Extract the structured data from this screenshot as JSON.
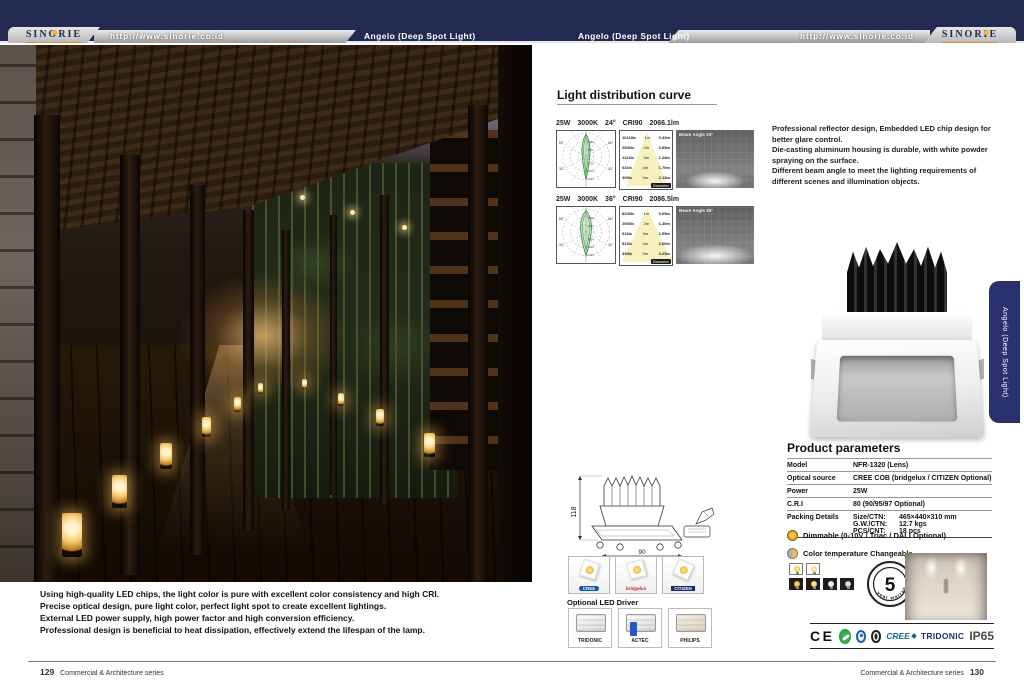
{
  "colors": {
    "header_navy": "#232a52",
    "tab_navy": "#2a3170",
    "accent_yellow": "#f0b41e",
    "cert_green": "#1d8a37"
  },
  "header": {
    "brand": "SINORIE",
    "url": "http://www.sinorie.co.id",
    "product": "Angelo (Deep Spot Light)"
  },
  "left_page": {
    "description": {
      "line1": "Using high-quality LED chips, the light color is pure with excellent color consistency and high CRI.",
      "line2": "Precise optical design, pure light color, perfect light spot to create excellent lightings.",
      "line3": "External LED power supply, high power factor and high conversion efficiency.",
      "line4": "Professional design is beneficial to heat dissipation, effectively extend the lifespan of the lamp."
    },
    "footer": {
      "page_number": "129",
      "series": "Commercial & Architecture series"
    }
  },
  "right_page": {
    "intro": {
      "line1": "Professional reflector design, Embedded LED chip design for better glare control.",
      "line2": "Die-casting aluminum housing is durable, with white powder spraying on the surface.",
      "line3": "Different beam angle to meet the lighting requirements of different scenes and illumination objects."
    },
    "curve_section": {
      "title": "Light distribution curve",
      "angle_upper": "30°",
      "angle_lower": "60°",
      "rows": [
        {
          "spec": {
            "power": "25W",
            "cct": "3000K",
            "angle": "24°",
            "cri": "CRI90",
            "flux": "2066.1lm"
          },
          "beam_label": "Beam Angle  24°",
          "polar_scale": {
            "s1": "1426",
            "s2": "2852",
            "s3": "4278",
            "s4": "5704",
            "s5": "7130"
          },
          "cone": [
            {
              "lux": "10118lx",
              "dist": "1m",
              "dia": "0.43m"
            },
            {
              "lux": "2530lx",
              "dist": "2m",
              "dia": "0.85m"
            },
            {
              "lux": "1124lx",
              "dist": "3m",
              "dia": "1.28m"
            },
            {
              "lux": "632lx",
              "dist": "4m",
              "dia": "1.70m"
            },
            {
              "lux": "405lx",
              "dist": "5m",
              "dia": "2.13m"
            }
          ],
          "cone_footer": "Diameter"
        },
        {
          "spec": {
            "power": "25W",
            "cct": "3000K",
            "angle": "36°",
            "cri": "CRI90",
            "flux": "2086.5lm"
          },
          "beam_label": "Beam Angle  36°",
          "polar_scale": {
            "s1": "1298",
            "s2": "2596",
            "s3": "3894",
            "s4": "5192",
            "s5": "6490"
          },
          "cone": [
            {
              "lux": "8240lx",
              "dist": "1m",
              "dia": "0.65m"
            },
            {
              "lux": "2060lx",
              "dist": "2m",
              "dia": "1.30m"
            },
            {
              "lux": "916lx",
              "dist": "3m",
              "dia": "1.95m"
            },
            {
              "lux": "515lx",
              "dist": "4m",
              "dia": "2.60m"
            },
            {
              "lux": "330lx",
              "dist": "5m",
              "dia": "3.25m"
            }
          ],
          "cone_footer": "Diameter"
        }
      ]
    },
    "side_tab": "Angelo (Deep Spot Light)",
    "parameters": {
      "title": "Product parameters",
      "model_label": "Model",
      "model": "NFR-1320  (Lens)",
      "source_label": "Optical source",
      "source": "CREE COB (bridgelux / CITIZEN Optional)",
      "power_label": "Power",
      "power": "25W",
      "cri_label": "C.R.I",
      "cri": "80 (90/95/97 Optional)",
      "packing_label": "Packing Details",
      "size_label": "Size/CTN:",
      "size": "465×440×310 mm",
      "gw_label": "G.W./CTN:",
      "gw": "12.7 kgs",
      "pcs_label": "PCS/CNT:",
      "pcs": "18 pcs"
    },
    "features": {
      "dimmable": "Dimmable (0-10V / Triac / DALI Optional)",
      "cct_changeable": "Color temperature Changeable"
    },
    "warranty": {
      "number": "5",
      "label": "year warranty"
    },
    "drawing": {
      "height": "118",
      "width": "90"
    },
    "chips": {
      "c1": "CREE",
      "c2": "bridgelux",
      "c3": "CITIZEN"
    },
    "drivers": {
      "title": "Optional LED Driver",
      "d1": "TRIDONIC",
      "d2": "ACTEC",
      "d3": "PHILIPS"
    },
    "certs": {
      "ce": "CE",
      "cree": "CREE",
      "tridonic": "TRIDONIC",
      "ip": "IP65"
    },
    "footer": {
      "series": "Commercial & Architecture series",
      "page_number": "130"
    }
  }
}
